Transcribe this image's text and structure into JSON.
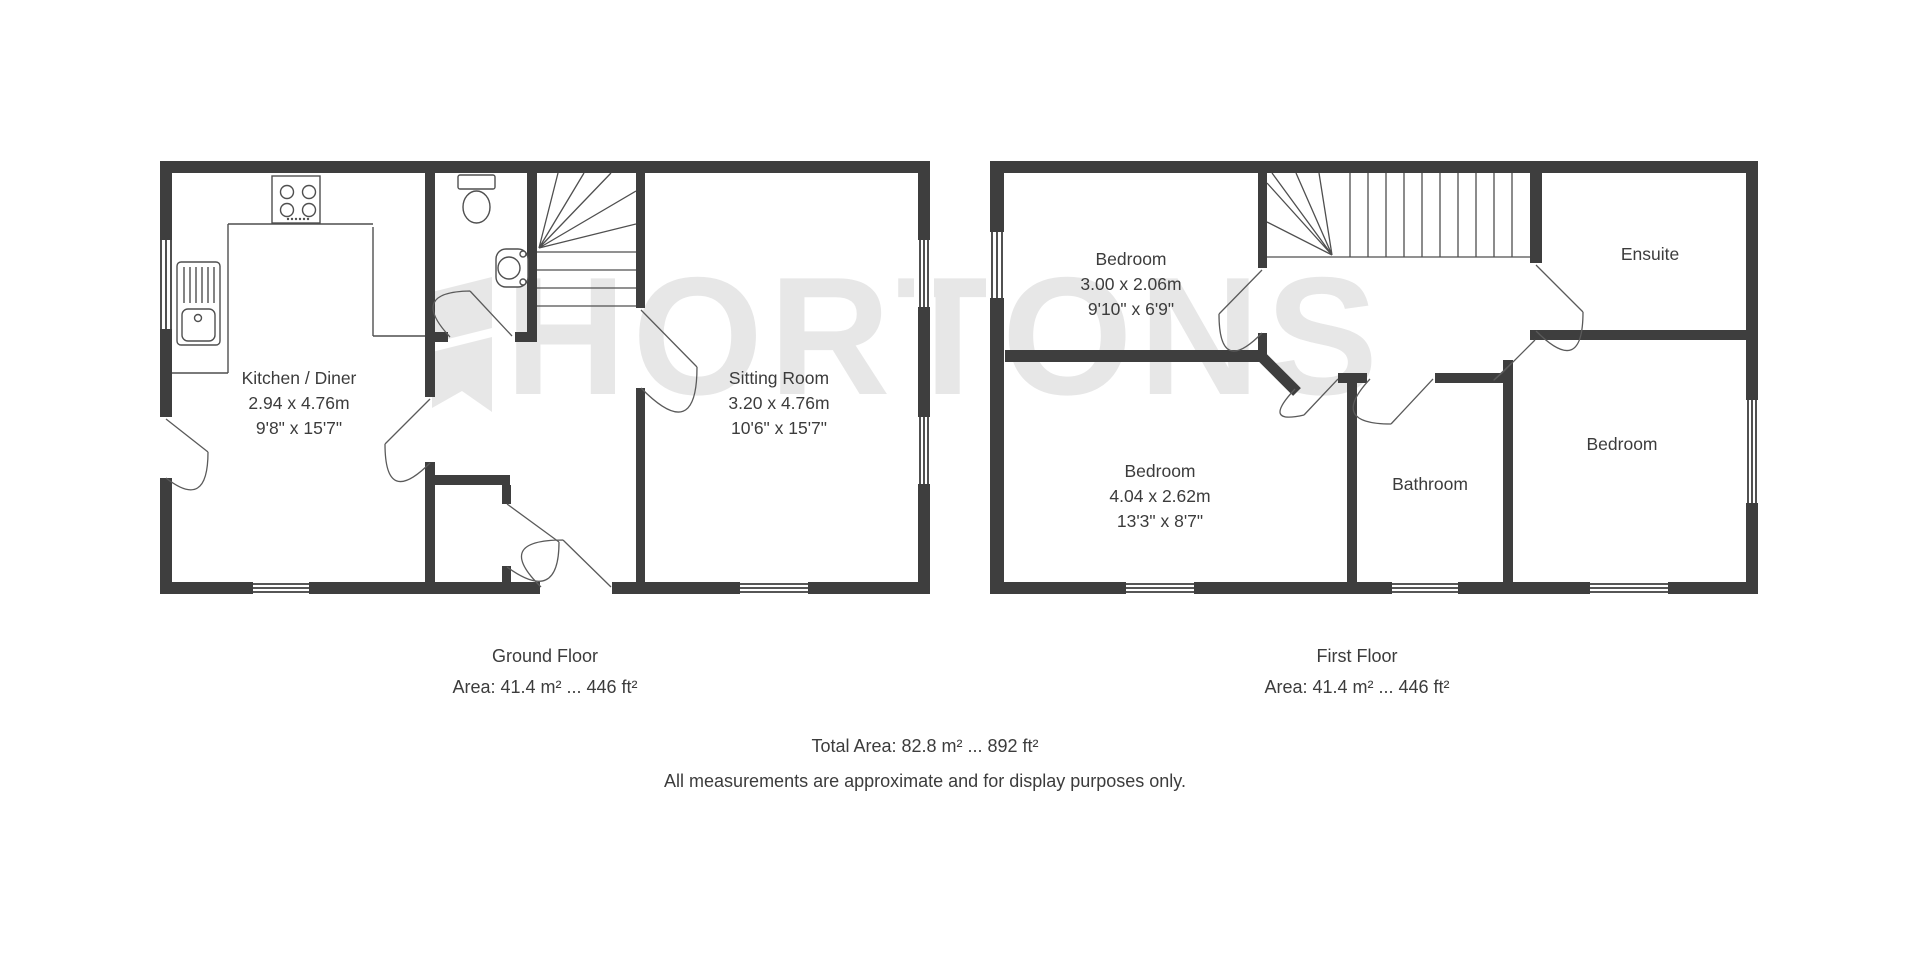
{
  "watermark": {
    "text": "HORTONS"
  },
  "ground_floor": {
    "label": "Ground Floor",
    "area": "Area: 41.4 m² ... 446 ft²",
    "rooms": [
      {
        "name": "Kitchen / Diner",
        "dim_m": "2.94 x 4.76m",
        "dim_ft": "9'8\" x 15'7\""
      },
      {
        "name": "Sitting Room",
        "dim_m": "3.20 x 4.76m",
        "dim_ft": "10'6\" x 15'7\""
      }
    ]
  },
  "first_floor": {
    "label": "First Floor",
    "area": "Area: 41.4 m² ... 446 ft²",
    "rooms": [
      {
        "name": "Bedroom",
        "dim_m": "3.00 x 2.06m",
        "dim_ft": "9'10\" x 6'9\""
      },
      {
        "name": "Bedroom",
        "dim_m": "4.04 x 2.62m",
        "dim_ft": "13'3\" x 8'7\""
      },
      {
        "name": "Bathroom"
      },
      {
        "name": "Bedroom"
      },
      {
        "name": "Ensuite"
      }
    ]
  },
  "footer": {
    "total": "Total Area: 82.8 m² ... 892 ft²",
    "disclaimer": "All measurements are approximate and for display purposes only."
  },
  "colors": {
    "wall": "#3e3e3e",
    "line": "#4f4f4f",
    "text": "#3c3c3c",
    "watermark": "#e7e7e7"
  }
}
